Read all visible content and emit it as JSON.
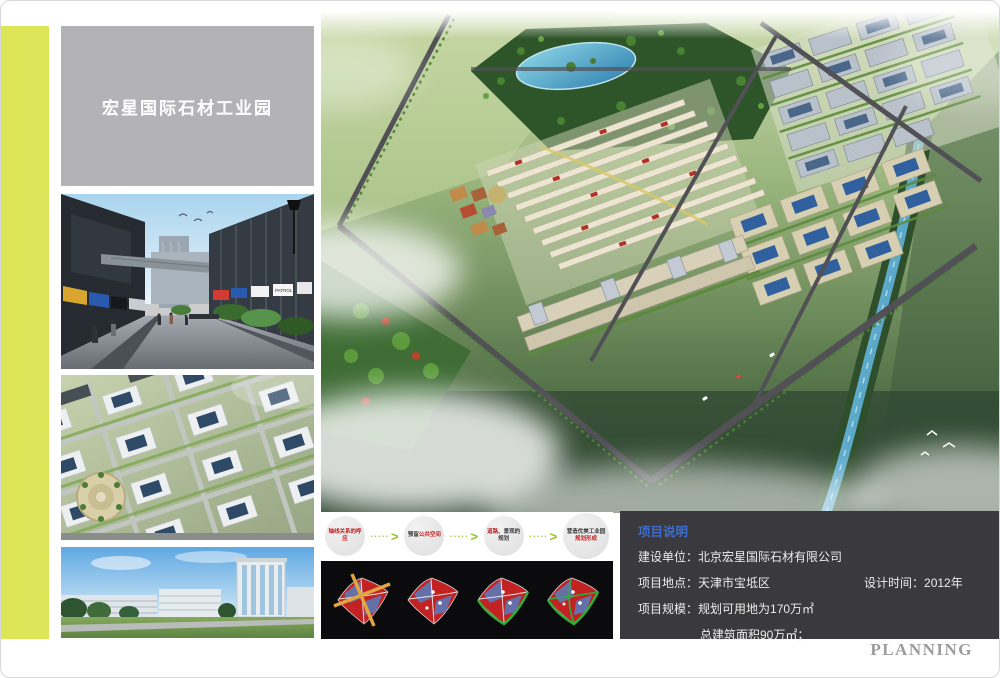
{
  "title_box": {
    "title": "宏星国际石材工业园"
  },
  "flow": {
    "steps": [
      {
        "a": "轴线关系的呼应"
      },
      {
        "a": "预留",
        "b": "公共空间"
      },
      {
        "a": "道路、",
        "b": "景观的规划"
      },
      {
        "a": "营造优美工业园",
        "b": "规划形成"
      }
    ]
  },
  "icons": {
    "arrow_dots": "•••••",
    "arrow_chevron": ">"
  },
  "project_info": {
    "header": "项目说明",
    "row1_label": "建设单位：",
    "row1_value": "北京宏星国际石材有限公司",
    "row2_label": "项目地点：",
    "row2_value": "天津市宝坻区",
    "row2b_label": "设计时间：",
    "row2b_value": "2012年",
    "row3_label": "项目规模：",
    "row3_value": "规划可用地为170万㎡",
    "row4_value": "总建筑面积90万㎡；"
  },
  "footer": {
    "planning": "PLANNING"
  },
  "photos": {
    "masterplan": {
      "name": "industrial-park-masterplan-aerial-rendering"
    },
    "street": {
      "name": "commercial-street-rendering",
      "sign": "PATROL"
    },
    "aerial": {
      "name": "industrial-park-aerial-rendering"
    },
    "building": {
      "name": "office-tower-rendering"
    }
  },
  "colors": {
    "accent_strip": "#dce557",
    "title_box_bg": "#b3b3b5",
    "info_box_bg": "#3a3a3e",
    "info_header_blue": "#3e6ccc",
    "flow_arrow_green": "#8dc41e",
    "flow_text_red": "#c01f1f",
    "planning_gray": "#9c9c9c"
  }
}
